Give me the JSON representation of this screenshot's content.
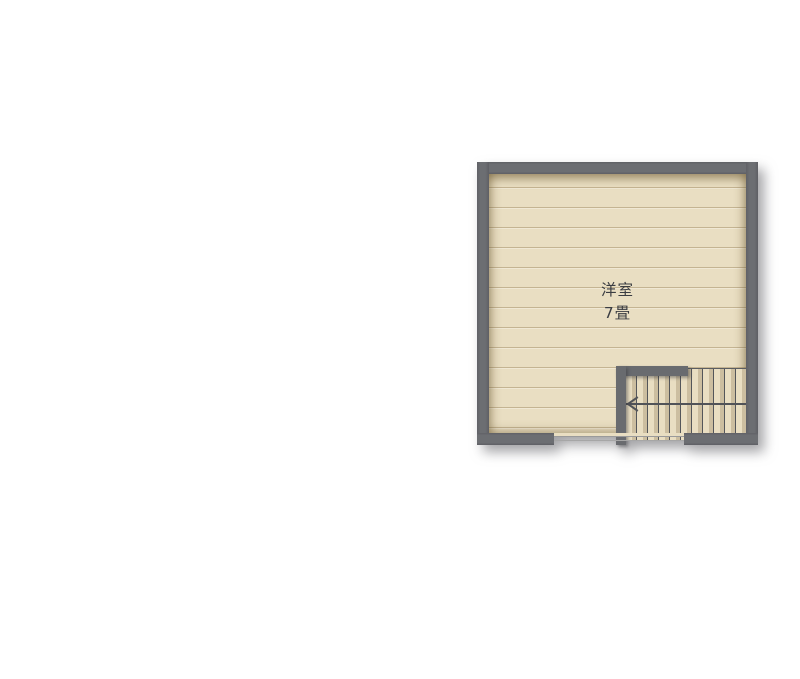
{
  "floor_plan": {
    "room": {
      "name": "洋室",
      "size": "7畳"
    },
    "stairs": {
      "tread_count": 11,
      "direction_arrow": "left",
      "arrow_icon": "chevron-left"
    },
    "colors": {
      "background": "#ffffff",
      "wall": "#696b6f",
      "floor": "#e9dec2",
      "plank_line": "#c4b491",
      "stair_tread_line": "#54565a",
      "opening_line": "#9a9a9a",
      "label_text": "#3b3d42"
    }
  }
}
